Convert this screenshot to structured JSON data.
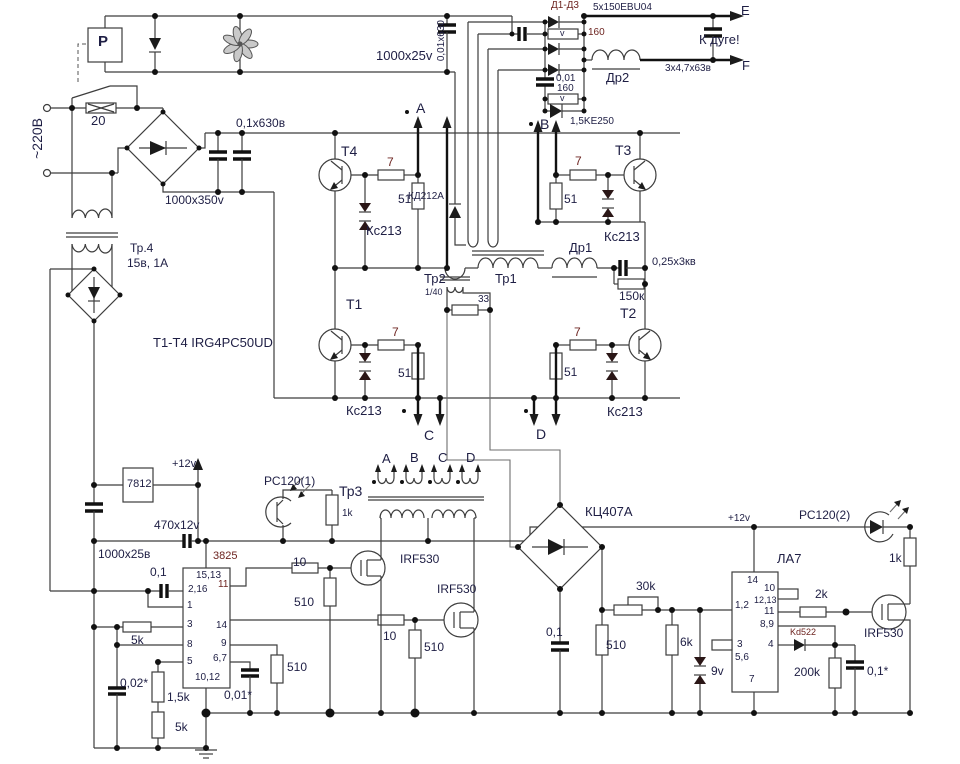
{
  "diagram": {
    "power_input": {
      "relay": "P",
      "fuse": "20",
      "mains": "~220В",
      "snubber_cap": "0,1x630в",
      "bulk_cap": "1000x350v",
      "aux_transformer": "Тр.4",
      "aux_rating": "15в, 1А",
      "fan_cap": "1000x25v",
      "hv_cap": "0,01x630"
    },
    "output": {
      "diodes": "Д1-Д3",
      "diodes_type": "5x150EBU04",
      "varistor": "v",
      "r1": "160",
      "c2": "0,01",
      "r2": "160",
      "tvs": "1,5KE250",
      "choke2": "Др2",
      "out_cap": "3х4,7х63в",
      "to_arc": "К дуге!",
      "term_e": "E",
      "term_f": "F"
    },
    "bridge": {
      "note": "T1-T4 IRG4PC50UD",
      "t1": "T1",
      "t2": "T2",
      "t3": "T3",
      "t4": "T4",
      "rg": "7",
      "re": "51",
      "zener": "Кс213",
      "free_diode": "КД212А",
      "phase_a": "A",
      "phase_b": "В",
      "phase_c": "C",
      "phase_d": "D",
      "ct": "Тр2",
      "ct_ratio": "1/40",
      "ct_load": "33",
      "tr_main": "Тр1",
      "choke1": "Др1",
      "res_cap": "0,25x3кв",
      "bleed": "150к"
    },
    "psu": {
      "regulator": "7812",
      "plus12": "+12v",
      "cap": "470x12v",
      "bulk": "1000x25в"
    },
    "pwm": {
      "chip": "3825",
      "pins": {
        "p15_13": "15,13",
        "p2_16": "2,16",
        "p11": "11",
        "p1": "1",
        "p3": "3",
        "p14": "14",
        "p8": "8",
        "p9": "9",
        "p5": "5",
        "p6_7": "6,7",
        "p10_12": "10,12"
      },
      "c1": "0,1",
      "r5k": "5k",
      "c2": "0,02*",
      "r15k": "1,5k",
      "c3": "0,01*",
      "r510": "510",
      "r10": "10"
    },
    "driver": {
      "opto1": "РС120(1)",
      "r_opto": "1k",
      "tr": "Тр3",
      "w_a": "A",
      "w_b": "B",
      "w_c": "C",
      "w_d": "D",
      "fet": "IRF530"
    },
    "feedback": {
      "rect": "КЦ407А",
      "c1": "0,1",
      "r1": "510",
      "pot": "30k",
      "r2": "6k",
      "zener": "9v"
    },
    "logic": {
      "chip": "ЛА7",
      "plus12": "+12v",
      "pins": {
        "p14": "14",
        "p10": "10",
        "p12_13": "12,13",
        "p1_2": "1,2",
        "p11": "11",
        "p8_9": "8,9",
        "p3": "3",
        "p4": "4",
        "p5_6": "5,6",
        "p7": "7"
      },
      "r_gate": "2k",
      "diode": "Kd522",
      "r_t": "200k",
      "c_t": "0,1*",
      "opto2": "РС120(2)",
      "r_led": "1k",
      "fet": "IRF530"
    }
  }
}
